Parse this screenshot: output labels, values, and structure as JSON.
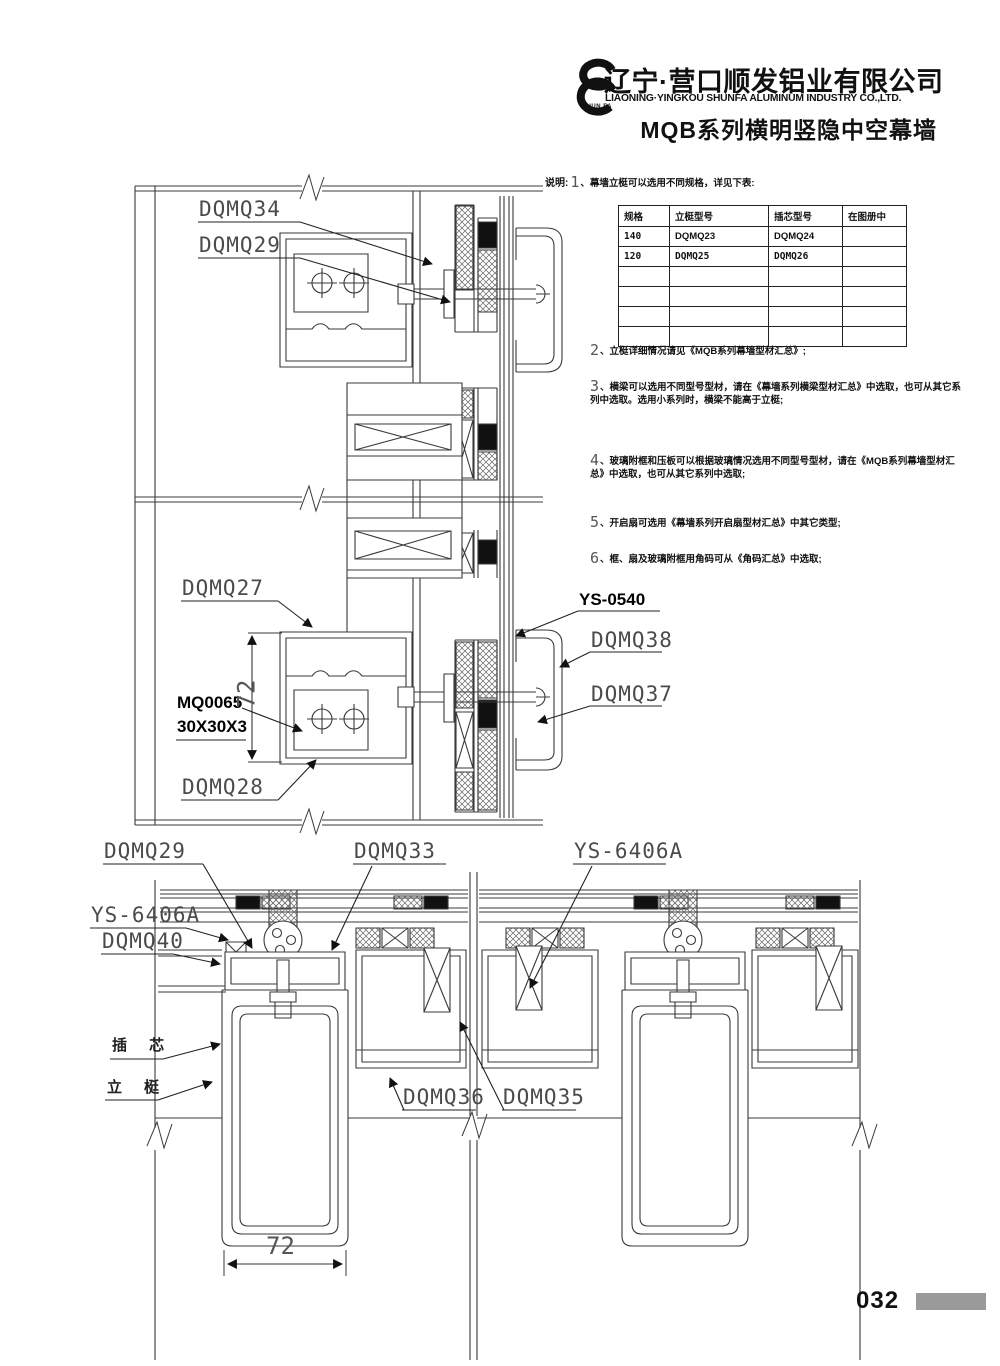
{
  "header": {
    "logo_text": "SHUN FA",
    "company_cn": "辽宁·营口顺发铝业有限公司",
    "company_en": "LIAONING·YINGKOU SHUNFA ALUMINUM INDUSTRY CO.,LTD.",
    "series_title": "MQB系列横明竖隐中空幕墙"
  },
  "notes": {
    "intro": "说明:",
    "n1": {
      "num": "1",
      "text": "、幕墙立梃可以选用不同规格，详见下表:"
    },
    "n2": {
      "num": "2",
      "text": "、立梃详细情况请见《MQB系列幕墙型材汇总》;"
    },
    "n3": {
      "num": "3",
      "text": "、横梁可以选用不同型号型材，请在《幕墙系列横梁型材汇总》中选取，也可从其它系列中选取。选用小系列时，横梁不能高于立梃;"
    },
    "n4": {
      "num": "4",
      "text": "、玻璃附框和压板可以根据玻璃情况选用不同型号型材，请在《MQB系列幕墙型材汇总》中选取，也可从其它系列中选取;"
    },
    "n5": {
      "num": "5",
      "text": "、开启扇可选用《幕墙系列开启扇型材汇总》中其它类型;"
    },
    "n6": {
      "num": "6",
      "text": "、框、扇及玻璃附框用角码可从《角码汇总》中选取;"
    }
  },
  "spec_table": {
    "headers": [
      "规格",
      "立梃型号",
      "插芯型号",
      "在图册中"
    ],
    "rows": [
      [
        "140",
        "DQMQ23",
        "DQMQ24",
        ""
      ],
      [
        "120",
        "DQMQ25",
        "DQMQ26",
        ""
      ],
      [
        "",
        "",
        "",
        ""
      ],
      [
        "",
        "",
        "",
        ""
      ],
      [
        "",
        "",
        "",
        ""
      ],
      [
        "",
        "",
        "",
        ""
      ]
    ]
  },
  "labels": {
    "dqmq34": "DQMQ34",
    "dqmq29_top": "DQMQ29",
    "dqmq27": "DQMQ27",
    "ys0540": "YS-0540",
    "dqmq38": "DQMQ38",
    "dqmq37": "DQMQ37",
    "mq0065": "MQ0065",
    "mq0065_size": "30X30X3",
    "dqmq28": "DQMQ28",
    "dqmq29_bottom": "DQMQ29",
    "dqmq33": "DQMQ33",
    "ys6406a_top": "YS-6406A",
    "ys6406a_left": "YS-6406A",
    "dqmq40": "DQMQ40",
    "insert_core": "插 芯",
    "mullion": "立 梃",
    "dqmq36": "DQMQ36",
    "dqmq35": "DQMQ35"
  },
  "dimensions": {
    "mullion_depth": "72",
    "mullion_width": "72"
  },
  "footer": {
    "page_number": "032"
  }
}
